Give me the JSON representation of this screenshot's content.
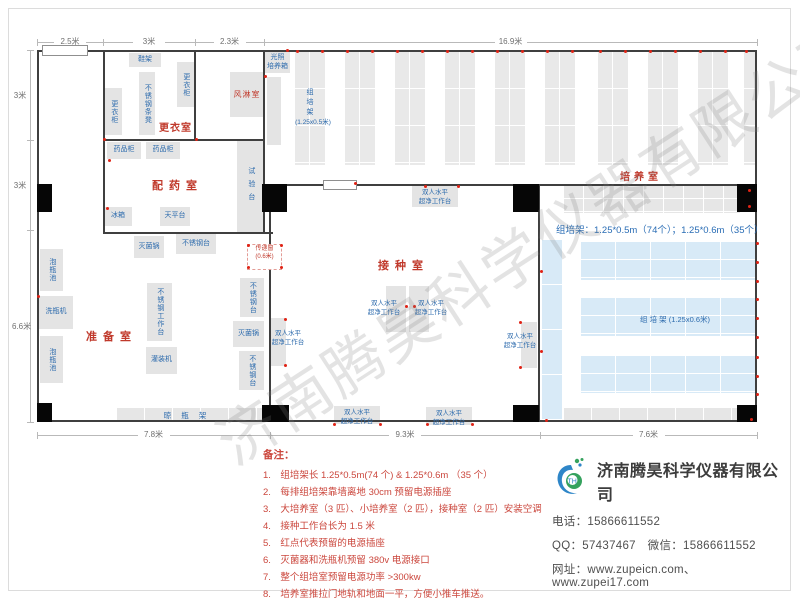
{
  "watermark": "济南腾昊科学仪器有限公司",
  "labels": {
    "bench": "双人水平\n超净工作台",
    "pass_window": "传递窗\n(0.6米)",
    "rack_v": "组培架",
    "rack_v_spec": "(1.25x0.5米)",
    "blue_rack": "组 培 架 (1.25x0.6米)",
    "summary": "组培架：1.25*0.5m（74个）；1.25*0.6m（35个）",
    "drying_rack": "晾瓶架"
  },
  "rooms": [
    {
      "t": "更衣室",
      "x": 159,
      "y": 119,
      "ls": 1,
      "fs": 10
    },
    {
      "t": "配药室",
      "x": 152,
      "y": 177,
      "ls": 6,
      "fs": 11
    },
    {
      "t": "准备室",
      "x": 86,
      "y": 328,
      "ls": 6,
      "fs": 11
    },
    {
      "t": "接种室",
      "x": 378,
      "y": 257,
      "ls": 6,
      "fs": 11
    },
    {
      "t": "培养室",
      "x": 620,
      "y": 168,
      "ls": 4,
      "fs": 10
    }
  ],
  "dims": {
    "top": {
      "pos": 42,
      "segs": [
        {
          "l": "2.5米",
          "a": 37,
          "b": 103
        },
        {
          "l": "3米",
          "a": 103,
          "b": 195
        },
        {
          "l": "2.3米",
          "a": 195,
          "b": 264
        },
        {
          "l": "16.9米",
          "a": 264,
          "b": 757
        }
      ]
    },
    "left": {
      "pos": 30,
      "segs": [
        {
          "l": "3米",
          "a": 50,
          "b": 140
        },
        {
          "l": "3米",
          "a": 140,
          "b": 230
        },
        {
          "l": "6.6米",
          "a": 230,
          "b": 422
        }
      ]
    },
    "bottom": {
      "pos": 435,
      "segs": [
        {
          "l": "7.8米",
          "a": 37,
          "b": 270
        },
        {
          "l": "9.3米",
          "a": 270,
          "b": 540
        },
        {
          "l": "7.6米",
          "a": 540,
          "b": 757
        }
      ]
    }
  },
  "plan": {
    "walls": [
      [
        37,
        50,
        720,
        2
      ],
      [
        37,
        50,
        2,
        372
      ],
      [
        755,
        50,
        2,
        372
      ],
      [
        37,
        420,
        720,
        2
      ],
      [
        103,
        50,
        2,
        184
      ],
      [
        194,
        50,
        2,
        91
      ],
      [
        263,
        50,
        2,
        184
      ],
      [
        103,
        139,
        162,
        2
      ],
      [
        103,
        232,
        170,
        2
      ],
      [
        269,
        184,
        488,
        2
      ],
      [
        269,
        184,
        2,
        238
      ],
      [
        538,
        184,
        2,
        238
      ]
    ],
    "columns": [
      [
        37,
        184,
        15,
        28
      ],
      [
        262,
        184,
        25,
        28
      ],
      [
        513,
        184,
        26,
        28
      ],
      [
        737,
        184,
        20,
        28
      ],
      [
        37,
        403,
        15,
        19
      ],
      [
        262,
        405,
        27,
        17
      ],
      [
        513,
        405,
        26,
        17
      ],
      [
        737,
        405,
        20,
        17
      ]
    ],
    "doors": [
      [
        42,
        45,
        44,
        9
      ],
      [
        323,
        180,
        32,
        8
      ]
    ],
    "blocks": [
      {
        "t": "鞋架",
        "x": 129,
        "y": 53,
        "w": 32,
        "h": 14,
        "o": "h"
      },
      {
        "t": "更衣柜",
        "x": 177,
        "y": 62,
        "w": 17,
        "h": 45,
        "o": "v"
      },
      {
        "t": "不锈钢条凳",
        "x": 139,
        "y": 72,
        "w": 16,
        "h": 63,
        "o": "v"
      },
      {
        "t": "更衣柜",
        "x": 105,
        "y": 88,
        "w": 17,
        "h": 47,
        "o": "v"
      },
      {
        "t": "风淋室",
        "x": 230,
        "y": 72,
        "w": 34,
        "h": 45,
        "o": "h",
        "c": "red"
      },
      {
        "t": "光照\n培养箱",
        "x": 265,
        "y": 52,
        "w": 25,
        "h": 21,
        "o": "h"
      },
      {
        "t": "",
        "x": 267,
        "y": 77,
        "w": 14,
        "h": 68,
        "o": "h"
      },
      {
        "t": "药品柜",
        "x": 107,
        "y": 142,
        "w": 34,
        "h": 17,
        "o": "h"
      },
      {
        "t": "药品柜",
        "x": 146,
        "y": 142,
        "w": 34,
        "h": 17,
        "o": "h"
      },
      {
        "t": "试验台",
        "x": 237,
        "y": 141,
        "w": 27,
        "h": 91,
        "o": "v",
        "sp": true
      },
      {
        "t": "冰箱",
        "x": 104,
        "y": 207,
        "w": 28,
        "h": 19,
        "o": "h"
      },
      {
        "t": "天平台",
        "x": 160,
        "y": 207,
        "w": 30,
        "h": 19,
        "o": "h"
      },
      {
        "t": "灭菌锅",
        "x": 134,
        "y": 236,
        "w": 30,
        "h": 22,
        "o": "h"
      },
      {
        "t": "不锈钢台",
        "x": 176,
        "y": 234,
        "w": 40,
        "h": 20,
        "o": "h"
      },
      {
        "t": "泡瓶池",
        "x": 40,
        "y": 249,
        "w": 23,
        "h": 42,
        "o": "v"
      },
      {
        "t": "洗瓶机",
        "x": 39,
        "y": 296,
        "w": 34,
        "h": 33,
        "o": "h"
      },
      {
        "t": "泡瓶池",
        "x": 40,
        "y": 336,
        "w": 23,
        "h": 47,
        "o": "v"
      },
      {
        "t": "不锈钢工作台",
        "x": 147,
        "y": 283,
        "w": 25,
        "h": 58,
        "o": "v"
      },
      {
        "t": "灌装机",
        "x": 146,
        "y": 347,
        "w": 31,
        "h": 27,
        "o": "h"
      },
      {
        "t": "不锈钢台",
        "x": 240,
        "y": 278,
        "w": 24,
        "h": 39,
        "o": "v"
      },
      {
        "t": "灭菌锅",
        "x": 233,
        "y": 321,
        "w": 31,
        "h": 26,
        "o": "h"
      },
      {
        "t": "不锈钢台",
        "x": 239,
        "y": 351,
        "w": 25,
        "h": 39,
        "o": "v"
      }
    ],
    "benches": [
      [
        412,
        186,
        46,
        21
      ],
      [
        334,
        406,
        46,
        18
      ],
      [
        426,
        407,
        46,
        18
      ],
      [
        271,
        318,
        15,
        48
      ],
      [
        521,
        322,
        16,
        46
      ],
      [
        386,
        286,
        20,
        46
      ],
      [
        409,
        286,
        20,
        46
      ]
    ],
    "bench_labels": [
      [
        413,
        189
      ],
      [
        335,
        409
      ],
      [
        427,
        410
      ],
      [
        266,
        330
      ],
      [
        498,
        333
      ],
      [
        362,
        300
      ],
      [
        409,
        300
      ]
    ],
    "pass_window": {
      "x": 247,
      "y": 244,
      "w": 33,
      "h": 22
    },
    "racks_v": {
      "y": 52,
      "h": 113,
      "w": 30,
      "xs": [
        295,
        345,
        395,
        445,
        495,
        545,
        598,
        648,
        698
      ],
      "partial": {
        "x": 744,
        "w": 13
      }
    },
    "rack_vlabel": {
      "x": 304,
      "y": 88
    },
    "rack_spec": {
      "x": 293,
      "y": 116,
      "w": 40
    },
    "rack_h_top": {
      "x": 564,
      "y": 186,
      "w": 176,
      "h": 27
    },
    "blue_rows": [
      [
        581,
        242,
        174,
        38
      ],
      [
        581,
        298,
        174,
        38
      ],
      [
        581,
        356,
        174,
        37
      ]
    ],
    "blue_col": [
      542,
      240,
      20,
      182
    ],
    "blue_label": {
      "x": 640,
      "y": 314
    },
    "summary_pos": {
      "x": 556,
      "y": 222
    },
    "drying_rack": {
      "x": 117,
      "y": 408,
      "w": 146,
      "h": 14
    },
    "rack_h_bottom": {
      "x": 564,
      "y": 408,
      "w": 176,
      "h": 14
    },
    "outlets": [
      [
        106,
        207
      ],
      [
        108,
        159
      ],
      [
        264,
        75
      ],
      [
        286,
        49
      ],
      [
        37,
        295
      ],
      [
        247,
        244
      ],
      [
        280,
        244
      ],
      [
        247,
        266
      ],
      [
        280,
        266
      ],
      [
        424,
        185
      ],
      [
        457,
        185
      ],
      [
        405,
        305
      ],
      [
        413,
        305
      ],
      [
        284,
        318
      ],
      [
        284,
        364
      ],
      [
        519,
        321
      ],
      [
        519,
        366
      ],
      [
        333,
        423
      ],
      [
        379,
        423
      ],
      [
        426,
        423
      ],
      [
        471,
        423
      ],
      [
        354,
        182
      ],
      [
        756,
        242
      ],
      [
        756,
        261
      ],
      [
        756,
        280
      ],
      [
        756,
        298
      ],
      [
        756,
        317
      ],
      [
        756,
        336
      ],
      [
        756,
        356
      ],
      [
        756,
        375
      ],
      [
        756,
        393
      ],
      [
        540,
        270
      ],
      [
        540,
        350
      ],
      [
        545,
        419
      ],
      [
        748,
        189
      ],
      [
        748,
        205
      ],
      [
        750,
        418
      ],
      [
        195,
        138
      ],
      [
        103,
        138
      ]
    ]
  },
  "notes": {
    "title": "备注：",
    "items": [
      {
        "n": "1.",
        "t": "组培架长 1.25*0.5m(74 个) & 1.25*0.6m （35 个）"
      },
      {
        "n": "2.",
        "t": "每排组培架靠墙离地 30cm 预留电源插座"
      },
      {
        "n": "3.",
        "t": "大培养室（3 匹）、小培养室（2 匹），接种室（2 匹）安装空调"
      },
      {
        "n": "4.",
        "t": "接种工作台长为 1.5 米"
      },
      {
        "n": "5.",
        "t": "红点代表预留的电源插座"
      },
      {
        "n": "6.",
        "t": "灭菌器和洗瓶机预留 380v 电源接口"
      },
      {
        "n": "7.",
        "t": "整个组培室预留电源功率 >300kw"
      },
      {
        "n": "8.",
        "t": "培养室推拉门地轨和地面一平，方便小推车推送。"
      }
    ]
  },
  "company": {
    "name": "济南腾昊科学仪器有限公司",
    "lines": [
      "电话：15866611552",
      "QQ：57437467　微信：15866611552",
      "网址：www.zupeicn.com、www.zupei17.com"
    ]
  }
}
